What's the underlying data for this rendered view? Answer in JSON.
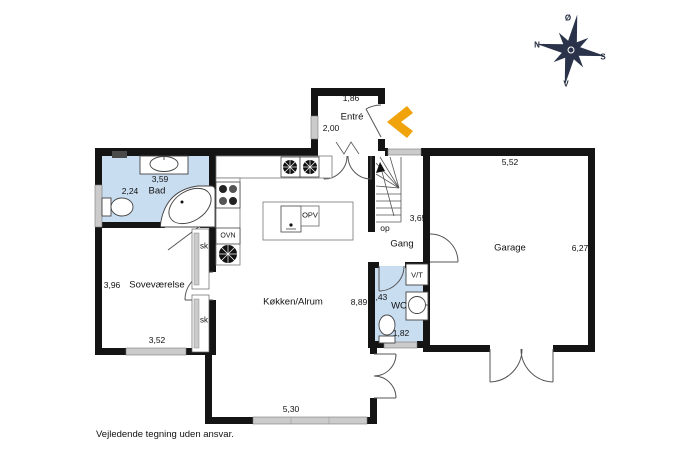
{
  "disclaimer": "Vejledende tegning uden ansvar.",
  "compass": {
    "east": "Ø",
    "west": "V",
    "north": "N",
    "south": "S"
  },
  "rooms": {
    "entre": {
      "name": "Entré",
      "dim_width": "1,86",
      "dim_depth": "2,00"
    },
    "bad": {
      "name": "Bad",
      "dim_width": "3,59",
      "dim_depth": "2,24"
    },
    "sovevaerelse": {
      "name": "Soveværelse",
      "dim_width": "3,52",
      "dim_depth": "3,96"
    },
    "koekken_alrum": {
      "name": "Køkken/Alrum",
      "dim_width": "5,30",
      "dim_depth": "8,89"
    },
    "gang": {
      "name": "Gang",
      "dim_depth": "3,65"
    },
    "wc": {
      "name": "WC",
      "dim_depth": "2,43",
      "dim_width": "1,82"
    },
    "garage": {
      "name": "Garage",
      "dim_width": "5,52",
      "dim_depth": "6,27"
    }
  },
  "fixtures": {
    "oven_label": "OVN",
    "dishwasher_label": "OPV",
    "washer_dryer_label": "V/T",
    "closet_label_1": "sk",
    "closet_label_2": "sk",
    "stairs_up_label": "op"
  },
  "colors": {
    "wall": "#141414",
    "wet_room_fill": "#c9ddf1",
    "window_fill": "#cbcbcb",
    "entrance_arrow": "#f0a30a",
    "compass": "#2a3349"
  }
}
